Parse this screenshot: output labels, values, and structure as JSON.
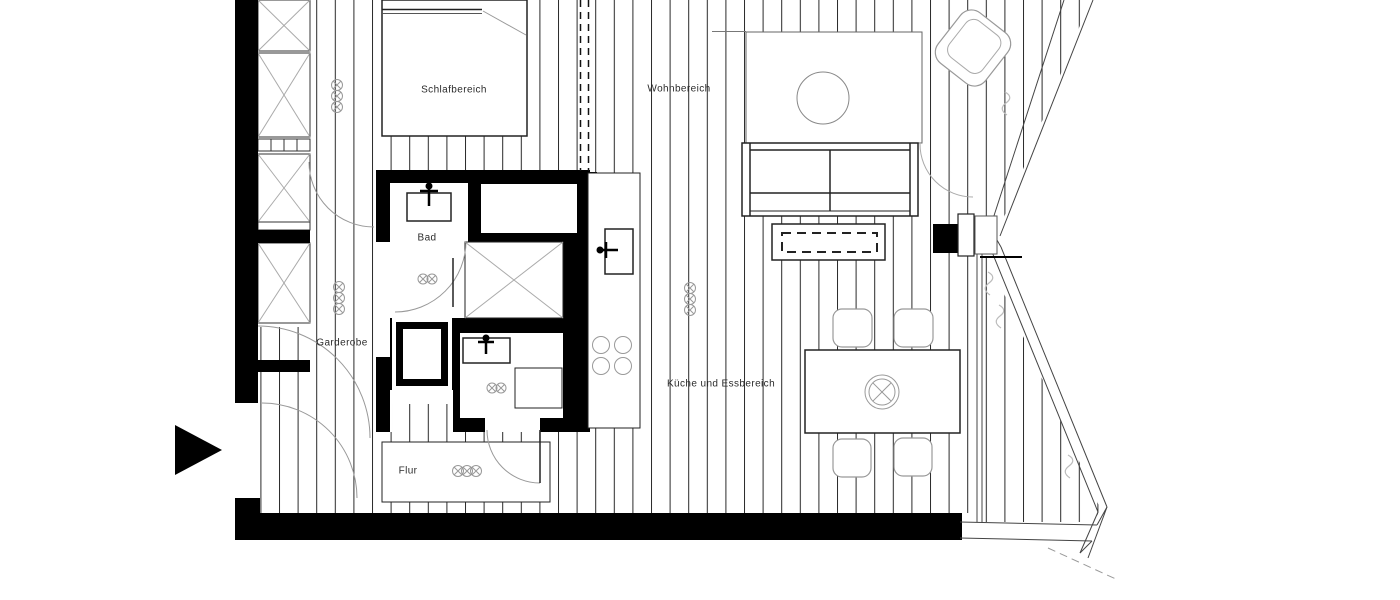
{
  "plan": {
    "title": "Wohnungsgrundriss",
    "rooms": {
      "schlafbereich": {
        "label": "Schlafbereich"
      },
      "wohnbereich": {
        "label": "Wohnbereich"
      },
      "bad": {
        "label": "Bad"
      },
      "garderobe": {
        "label": "Garderobe"
      },
      "kueche": {
        "label": "Küche und Essbereich"
      },
      "flur": {
        "label": "Flur"
      }
    },
    "icons": {
      "entrance_arrow": "entrance-arrow",
      "lamp": "ceiling-lamp",
      "faucet": "faucet"
    },
    "colors": {
      "wall": "#000000",
      "plank_line": "#2a2a2a",
      "furniture_line": "#222222",
      "light_line": "#999999",
      "background": "#ffffff"
    }
  }
}
